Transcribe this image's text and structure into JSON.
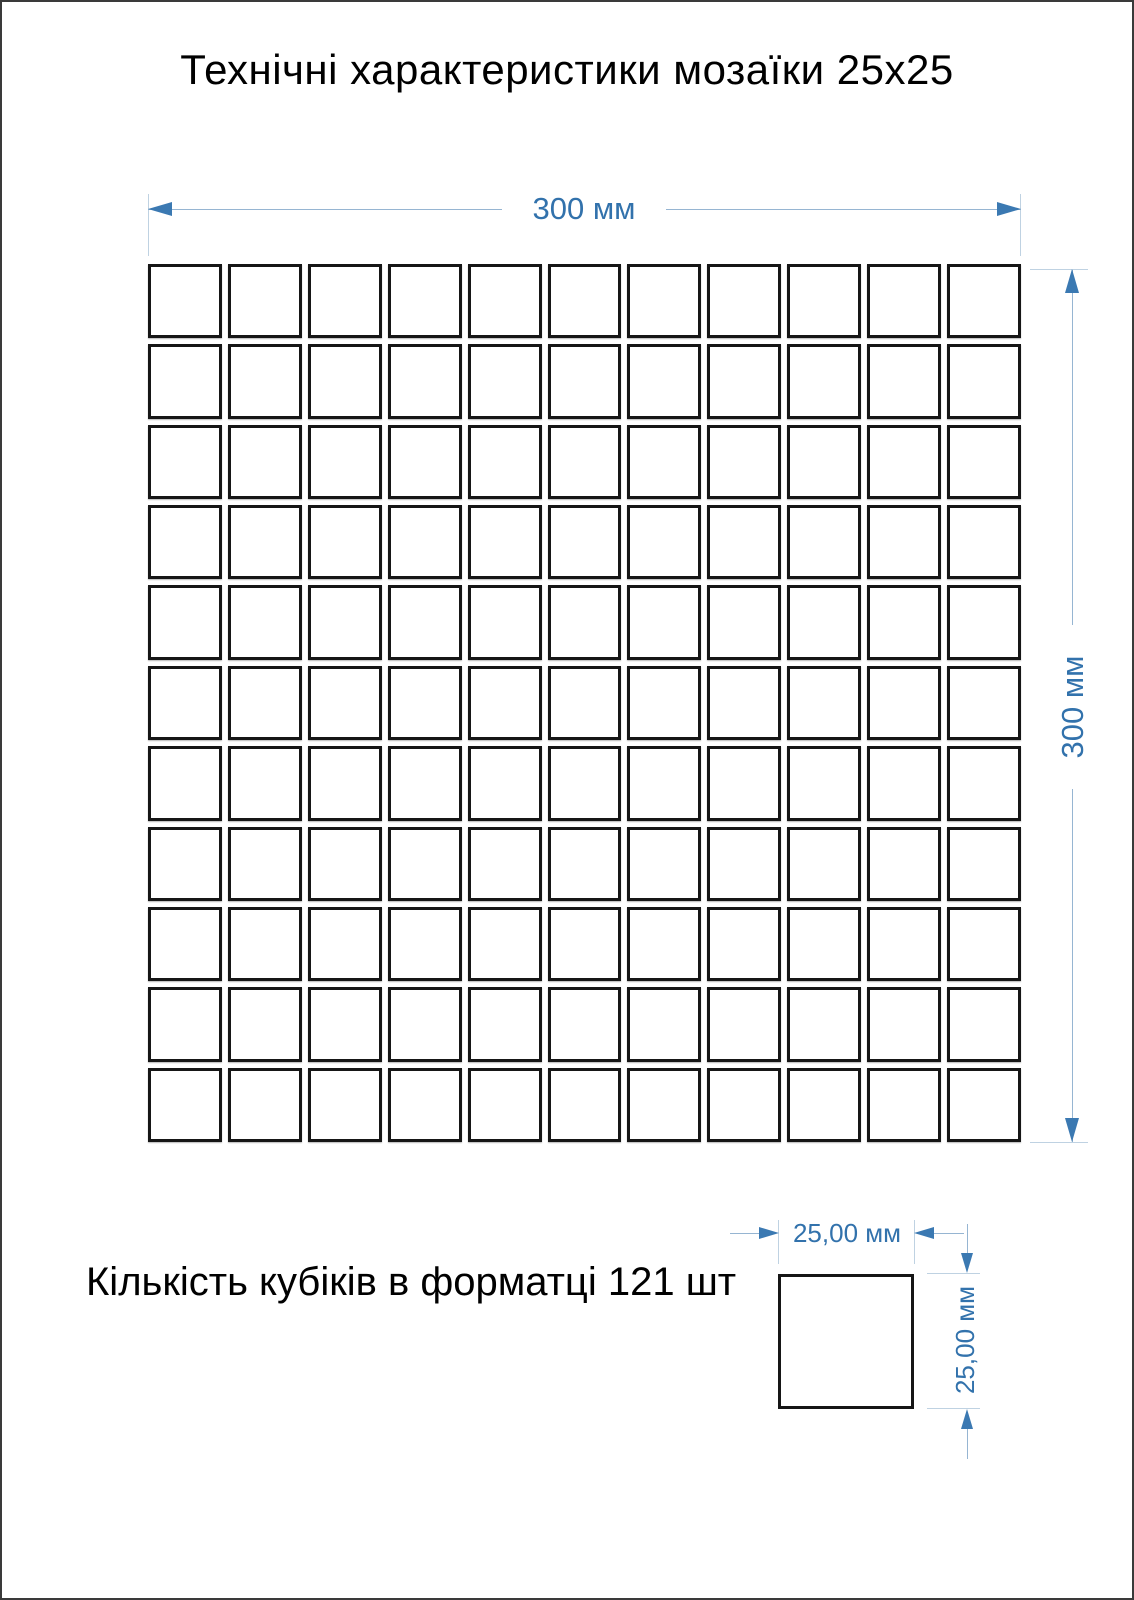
{
  "title": "Технічні характеристики мозаїки 25х25",
  "note": "Кількість кубіків в форматці 121 шт",
  "mosaic": {
    "rows": 11,
    "cols": 11,
    "cubes_total": 121
  },
  "dimensions": {
    "sheet_width": "300 мм",
    "sheet_height": "300 мм",
    "cube_width": "25,00 мм",
    "cube_height": "25,00 мм"
  },
  "colors": {
    "dimension_blue": "#3b79b2",
    "dimension_label_blue": "#3272ac",
    "dimension_line": "#96b5d2",
    "extension_line": "#bfd2e2",
    "tile_border": "#161616",
    "page_border": "#3a3a3a"
  }
}
